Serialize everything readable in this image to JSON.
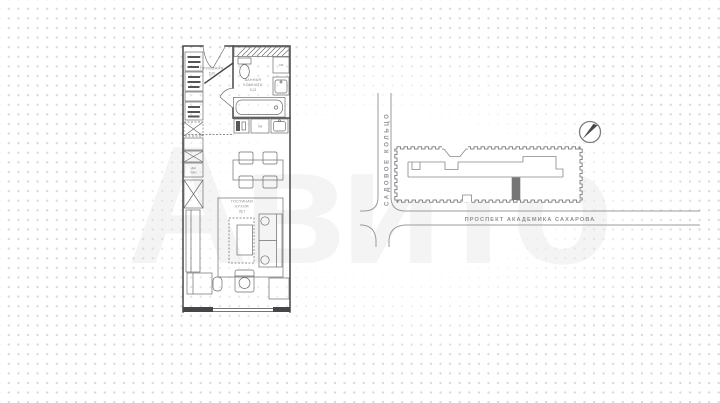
{
  "watermark": {
    "text": "Авито"
  },
  "floorplan": {
    "hallway": {
      "name": "ПРИХОЖАЯ",
      "area": "6,20"
    },
    "bathroom": {
      "line1": "ВАННАЯ",
      "line2": "КОМНАТА",
      "area": "5,13"
    },
    "living": {
      "line1": "ГОСТИНАЯ",
      "line2": "КУХНЯ",
      "area": "28,7"
    },
    "appliances": {
      "washer": "СМ",
      "dishwasher": "ПМ",
      "small": [
        "ДШ",
        "СВЧ"
      ]
    }
  },
  "map": {
    "street_vertical": "САДОВОЕ КОЛЬЦО",
    "street_horizontal": "ПРОСПЕКТ АКАДЕМИКА САХАРОВА",
    "compass_direction": "north-east"
  },
  "colors": {
    "plan_wall": "#46464a",
    "plan_furniture": "#6d6d71",
    "label_text": "#85858a",
    "map_line": "#9b9b9f",
    "building_line": "#87878b",
    "marker": "#767679",
    "dot_grid": "#d7d7dc"
  }
}
